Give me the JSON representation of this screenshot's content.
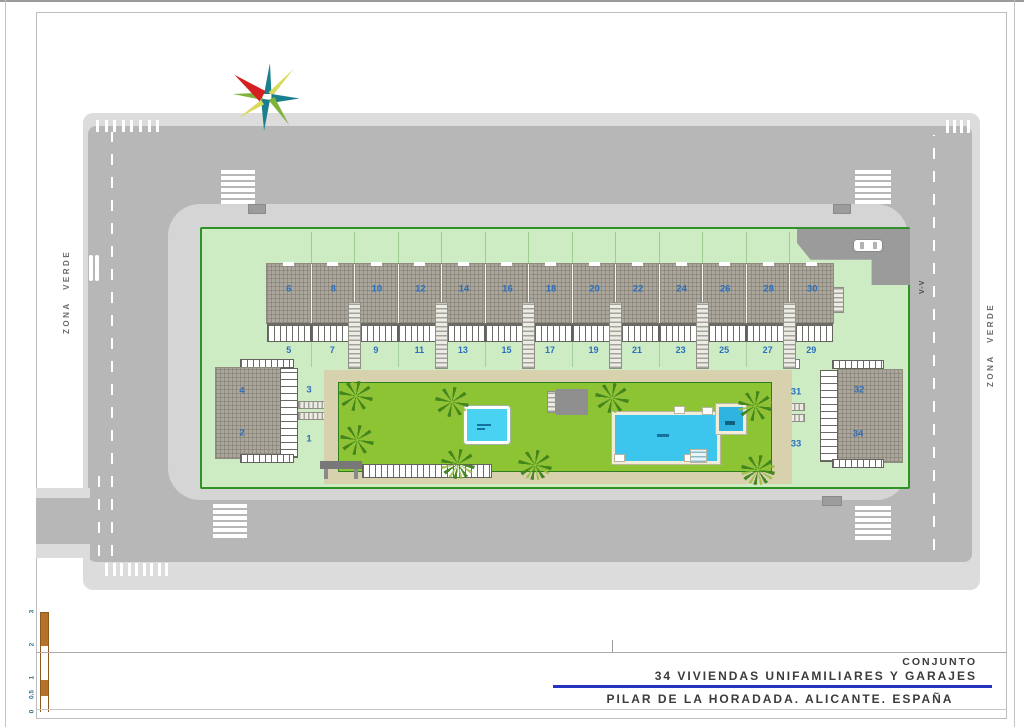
{
  "title_block": {
    "line1": "CONJUNTO",
    "line2": "34 VIVIENDAS UNIFAMILIARES Y GARAJES",
    "line3": "PILAR DE LA HORADADA. ALICANTE. ESPAÑA",
    "accent_color": "#2433c0"
  },
  "labels": {
    "zona_verde_left": "ZONA VERDE",
    "zona_verde_right": "ZONA VERDE",
    "section_mark": "V-V"
  },
  "scale_bar": {
    "tick_labels": [
      "0",
      "0.5",
      "1",
      "2",
      "3"
    ],
    "color": "#b5722a"
  },
  "plan": {
    "row_houses": {
      "roof_numbers": [
        "6",
        "8",
        "10",
        "12",
        "14",
        "16",
        "18",
        "20",
        "22",
        "24",
        "26",
        "28",
        "30"
      ],
      "garden_numbers": [
        "5",
        "7",
        "9",
        "11",
        "13",
        "15",
        "17",
        "19",
        "21",
        "23",
        "25",
        "27",
        "29"
      ]
    },
    "left_building": {
      "roof_numbers": [
        "4",
        "2"
      ],
      "garden_numbers": [
        "3",
        "1"
      ]
    },
    "right_building": {
      "roof_numbers": [
        "32",
        "34"
      ],
      "garden_numbers": [
        "31",
        "33"
      ]
    }
  },
  "icons": {
    "compass": "compass-rose-icon",
    "car": "car-icon",
    "palm": "palm-tree-icon"
  },
  "colors": {
    "road": "#b7b7b7",
    "sidewalk": "#d5d5d5",
    "parcel_green": "#cdecc4",
    "parcel_border": "#2f9126",
    "lawn": "#8cc433",
    "path_tan": "#d8d1ae",
    "roof_gray": "#aba79d",
    "pool_water": "#3cc6ee",
    "jacuzzi_water": "#2fb3e0",
    "pool_border": "#f1edd8",
    "house_number_blue": "#2b6fbe",
    "compass_red": "#d42020",
    "compass_teal": "#1a7f8e",
    "compass_yellow": "#d9d95a",
    "compass_green": "#7fb23a"
  }
}
